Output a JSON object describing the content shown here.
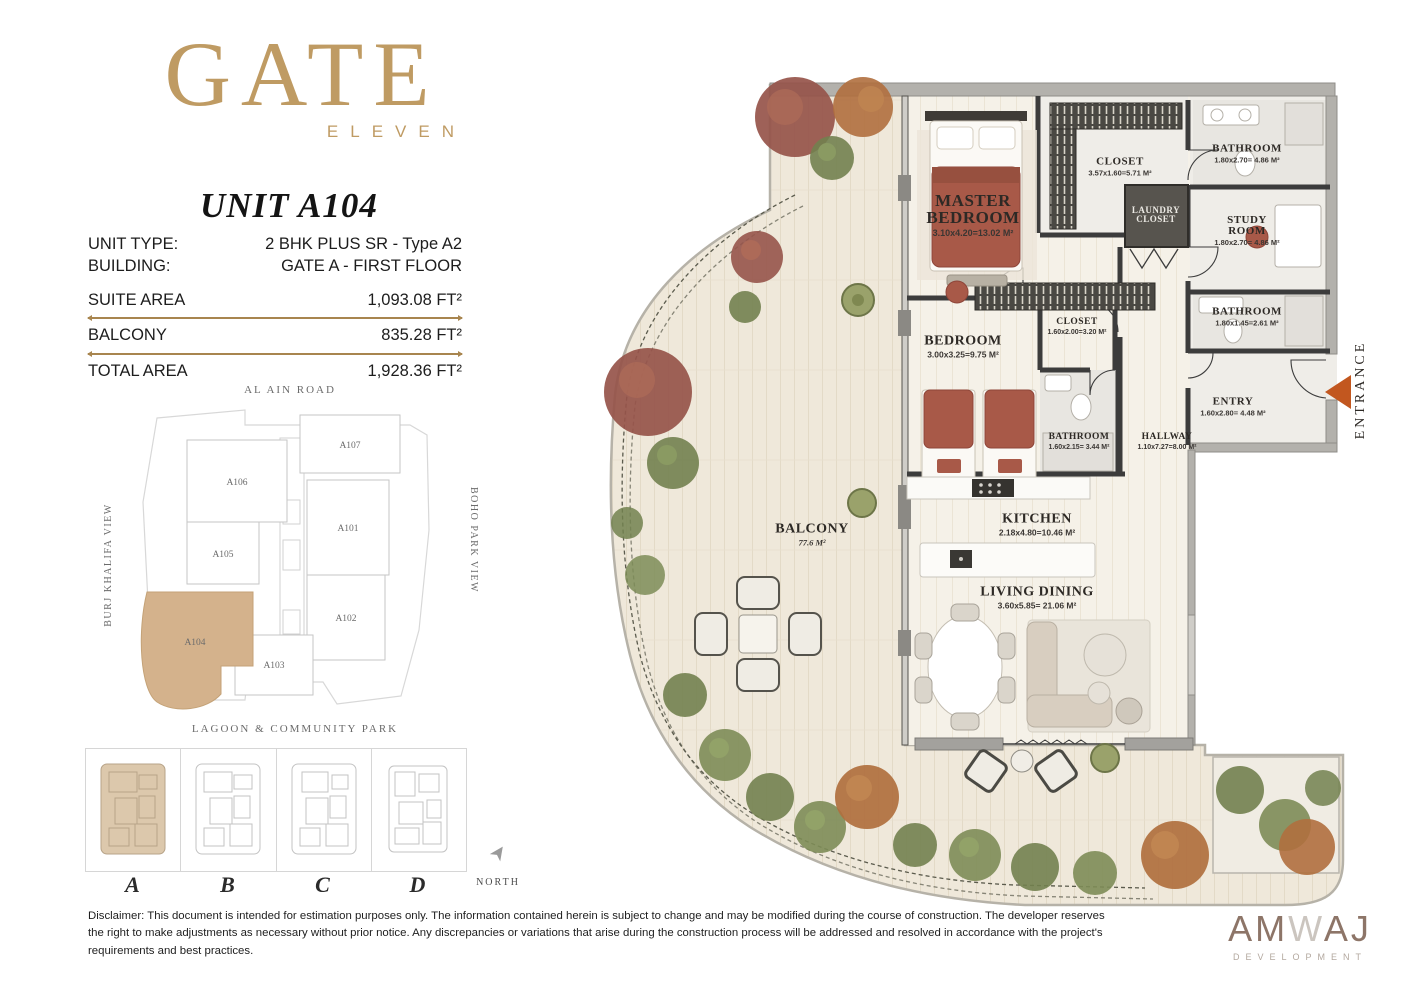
{
  "brand": {
    "logo_main": "GATE",
    "logo_sub": "ELEVEN",
    "unit_title": "UNIT A104"
  },
  "info": {
    "unit_type_label": "UNIT TYPE:",
    "unit_type_value": "2 BHK PLUS SR - Type A2",
    "building_label": "BUILDING:",
    "building_value": "GATE A - FIRST FLOOR",
    "suite_area_label": "SUITE AREA",
    "suite_area_value": "1,093.08 FT²",
    "balcony_label": "BALCONY",
    "balcony_value": "835.28 FT²",
    "total_area_label": "TOTAL AREA",
    "total_area_value": "1,928.36 FT²"
  },
  "site_plan": {
    "top_label": "AL AIN ROAD",
    "left_label": "BURJ KHALIFA VIEW",
    "right_label": "BOHO PARK VIEW",
    "bottom_label": "LAGOON & COMMUNITY PARK",
    "units": [
      {
        "id": "A107"
      },
      {
        "id": "A106"
      },
      {
        "id": "A105"
      },
      {
        "id": "A101"
      },
      {
        "id": "A102"
      },
      {
        "id": "A103"
      },
      {
        "id": "A104",
        "highlighted": true
      }
    ]
  },
  "building_key": {
    "items": [
      {
        "label": "A",
        "highlighted": true
      },
      {
        "label": "B",
        "highlighted": false
      },
      {
        "label": "C",
        "highlighted": false
      },
      {
        "label": "D",
        "highlighted": false
      }
    ],
    "north_label": "NORTH"
  },
  "floor_plan": {
    "rooms": [
      {
        "name": "MASTER BEDROOM",
        "dims": "3.10x4.20=13.02 M²"
      },
      {
        "name": "CLOSET",
        "dims": "3.57x1.60=5.71 M²"
      },
      {
        "name": "LAUNDRY CLOSET",
        "dims": ""
      },
      {
        "name": "BATHROOM",
        "dims": "1.80x2.70= 4.86 M²"
      },
      {
        "name": "STUDY ROOM",
        "dims": "1.80x2.70= 4.86 M²"
      },
      {
        "name": "BATHROOM",
        "dims": "1.80x1.45=2.61 M²"
      },
      {
        "name": "ENTRY",
        "dims": "1.60x2.80= 4.48 M²"
      },
      {
        "name": "BEDROOM",
        "dims": "3.00x3.25=9.75 M²"
      },
      {
        "name": "CLOSET",
        "dims": "1.60x2.00=3.20 M²"
      },
      {
        "name": "BATHROOM",
        "dims": "1.60x2.15= 3.44 M²"
      },
      {
        "name": "HALLWAY",
        "dims": "1.10x7.27=8.00 M²"
      },
      {
        "name": "KITCHEN",
        "dims": "2.18x4.80=10.46 M²"
      },
      {
        "name": "LIVING DINING",
        "dims": "3.60x5.85= 21.06 M²"
      },
      {
        "name": "BALCONY",
        "dims": "77.6 M²"
      }
    ],
    "entrance_label": "ENTRANCE"
  },
  "disclaimer": "Disclaimer: This document is intended for estimation purposes only. The information contained herein is subject to change and may be modified during the course of construction. The developer reserves the right to make adjustments as necessary without prior notice. Any discrepancies or variations that arise during the construction process will be addressed and resolved in accordance with the project's requirements and best practices.",
  "footer_logo": {
    "part1": "AM",
    "part2": "W",
    "part3": "AJ",
    "subtitle": "DEVELOPMENT"
  },
  "colors": {
    "accent_gold": "#bf9b63",
    "gold_rule": "#a8854f",
    "highlight_tan": "#d4b28c",
    "terracotta": "#a85948",
    "entrance_arrow": "#c2571f",
    "wall_dark": "#3c3c3c",
    "wall_light": "#b3b1ac"
  }
}
